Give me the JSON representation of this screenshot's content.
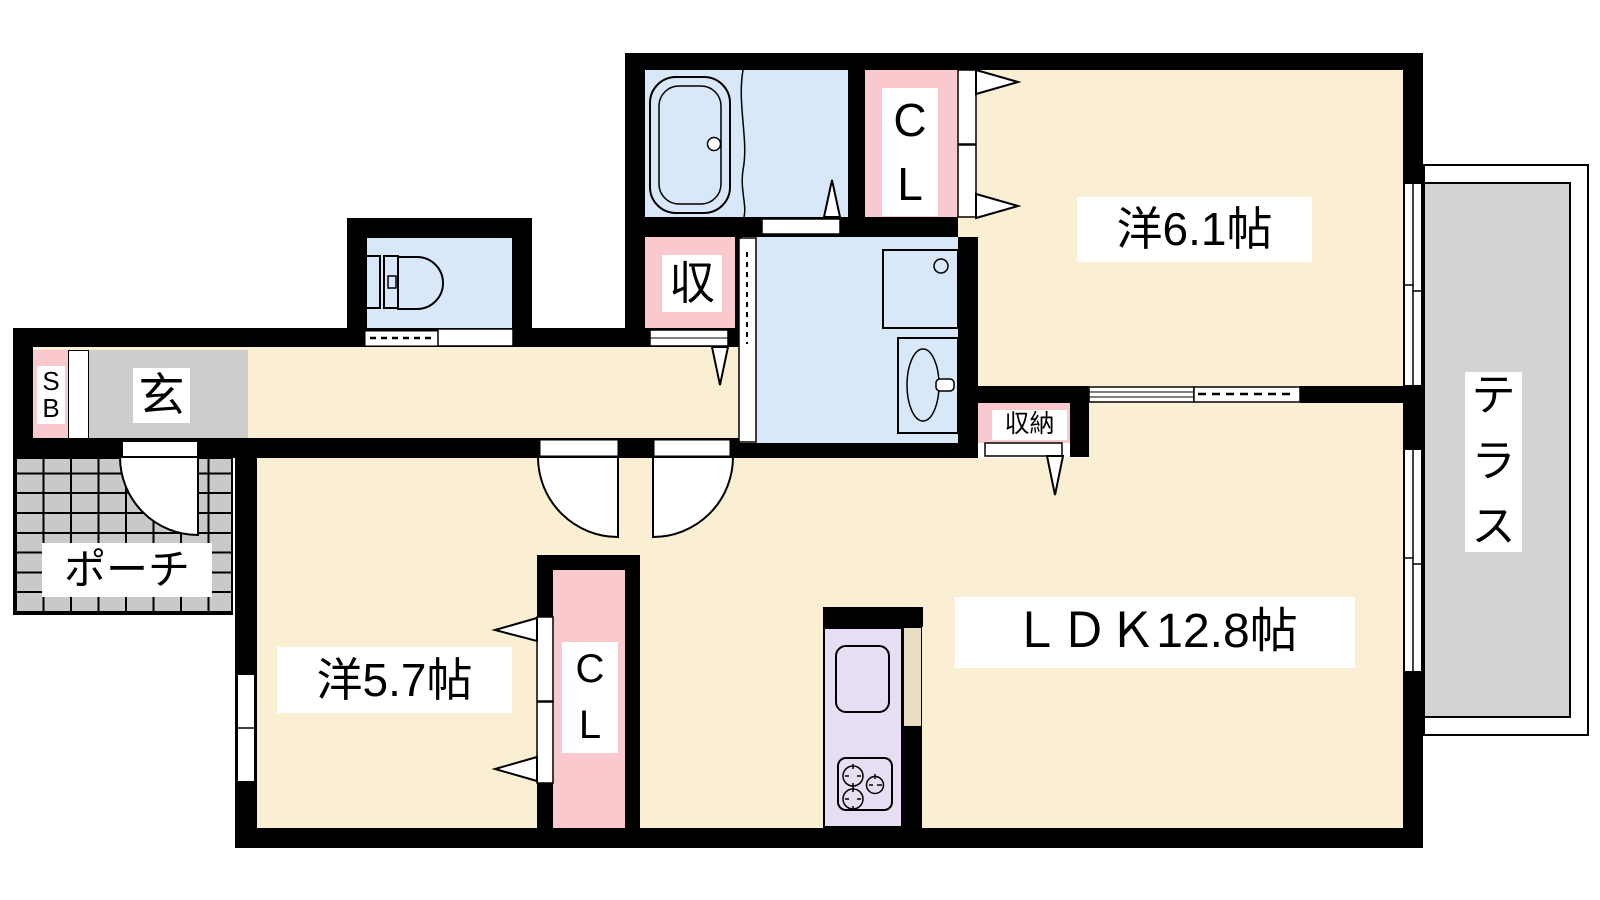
{
  "title": "1LDK apartment floor plan",
  "rooms": {
    "western_room_61": {
      "label": "洋6.1帖"
    },
    "western_room_57": {
      "label": "洋5.7帖"
    },
    "ldk": {
      "label": "ＬＤＫ12.8帖"
    },
    "terrace": {
      "label": "テラス",
      "chars": [
        "テ",
        "ラ",
        "ス"
      ]
    },
    "entrance": {
      "label": "玄"
    },
    "porch": {
      "label": "ポーチ"
    },
    "shoe_box": {
      "label": "SB",
      "chars": [
        "S",
        "B"
      ]
    },
    "hall_storage": {
      "label": "収"
    },
    "ldk_storage": {
      "label": "収納"
    },
    "closet_main": {
      "label": "CL",
      "chars": [
        "C",
        "L"
      ]
    },
    "closet_57": {
      "label": "CL",
      "chars": [
        "C",
        "L"
      ]
    }
  },
  "colors": {
    "wall": "#000000",
    "room": "#faefd2",
    "water": "#d9e8f8",
    "closet": "#f9c9ce",
    "kitchen": "#e7def4",
    "counter": "#e8dcc4",
    "tile": "#c9c9c9",
    "entrance": "#cccccc",
    "terrace": "#d3d3d3"
  }
}
